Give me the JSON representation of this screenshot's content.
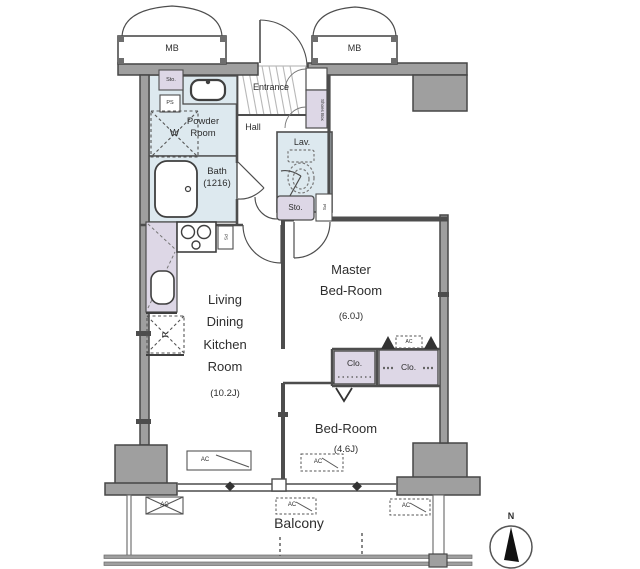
{
  "plan": {
    "title_hint": "apartment floor plan",
    "meter_box_left": "MB",
    "meter_box_right": "MB",
    "entrance": "Entrance",
    "shoes_box": "Shoes Box",
    "powder_room": "Powder\nRoom",
    "washing_machine": "W",
    "bath": "Bath\n(1216)",
    "hall": "Hall",
    "lavatory": "Lav.",
    "storage_top": "Sto.",
    "pipe_space_top": "PS",
    "storage_hall": "Sto.",
    "pipe_space_hall": "PS",
    "pipe_space_kitchen": "PS",
    "refrigerator": "R",
    "living": "Living\nDining\nKitchen\nRoom",
    "living_size": "(10.2J)",
    "master": "Master\nBed-Room",
    "master_size": "(6.0J)",
    "bedroom": "Bed-Room",
    "bedroom_size": "(4.6J)",
    "closet_small": "Clo.",
    "closet_large": "Clo.",
    "ac": "AC",
    "balcony": "Balcony",
    "compass_north": "N"
  },
  "colors": {
    "wall": "#9f9f9f",
    "wall_edge": "#474747",
    "wet_room": "#dde9ef",
    "closet": "#ddd7e6",
    "line": "#4d4d4d"
  }
}
